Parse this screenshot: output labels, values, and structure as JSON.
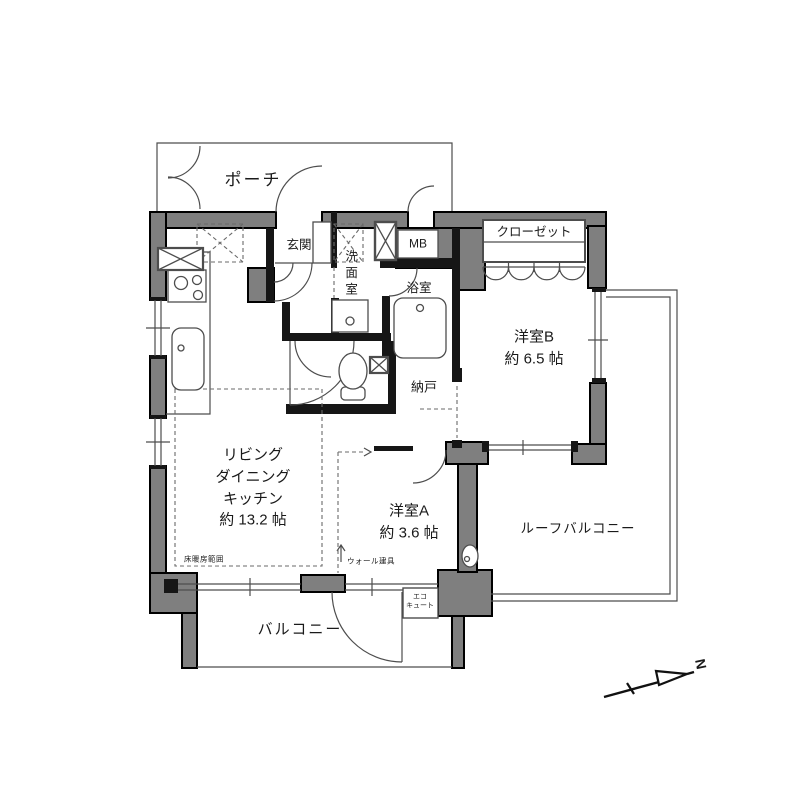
{
  "colors": {
    "wall": "#7f7f7f",
    "outline": "#000000",
    "line": "#4d4d4d",
    "background": "#ffffff"
  },
  "rooms": {
    "porch": {
      "label": "ポーチ"
    },
    "entrance": {
      "label": "玄関"
    },
    "washroom": {
      "label": "洗面室"
    },
    "meter_box": {
      "label": "MB"
    },
    "bathroom": {
      "label": "浴室"
    },
    "closet": {
      "label": "クローゼット"
    },
    "western_room_b": {
      "label": "洋室B",
      "size": "約 6.5 帖"
    },
    "storage": {
      "label": "納戸"
    },
    "ldk": {
      "line1": "リビング",
      "line2": "ダイニング",
      "line3": "キッチン",
      "size": "約 13.2 帖"
    },
    "western_room_a": {
      "label": "洋室A",
      "size": "約 3.6 帖"
    },
    "roof_balcony": {
      "label": "ルーフバルコニー"
    },
    "balcony": {
      "label": "バルコニー"
    }
  },
  "annotations": {
    "floor_heating": "床暖房範囲",
    "wall_fitting": "ウォール建具",
    "ecocute_line1": "エコ",
    "ecocute_line2": "キュート",
    "north_mark": "N"
  }
}
